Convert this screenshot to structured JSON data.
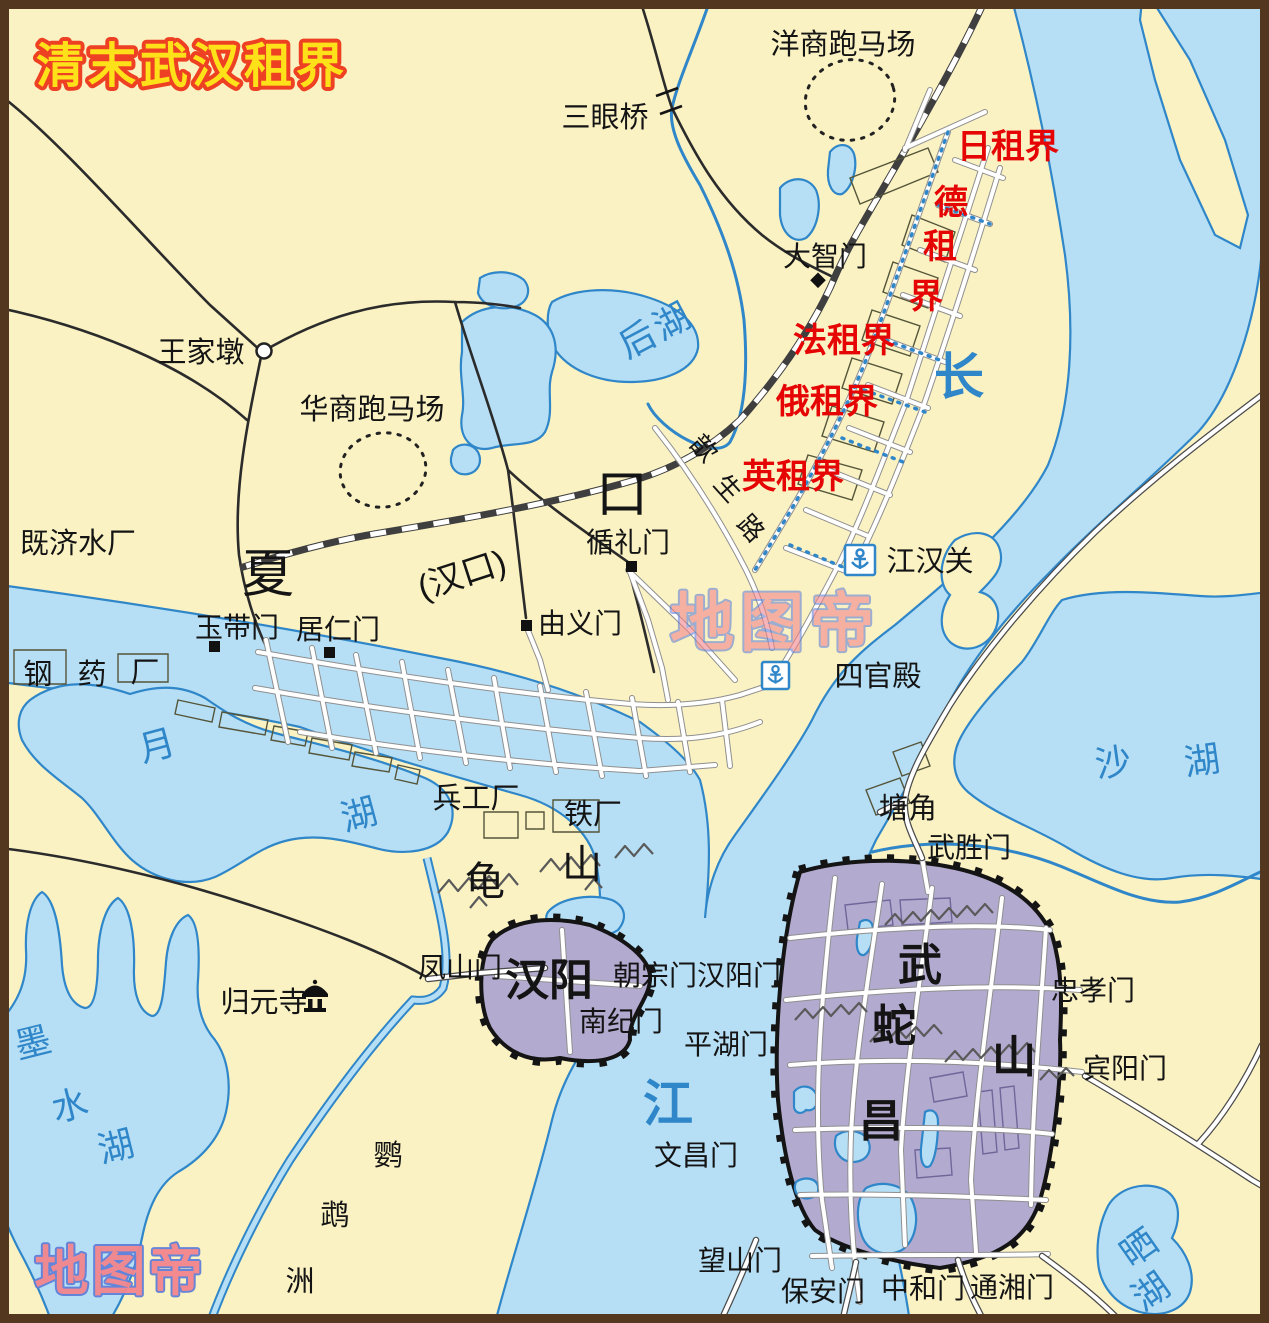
{
  "title": "清末武汉租界",
  "watermark": {
    "center": "地图帝",
    "corner": "地图帝"
  },
  "concessions": {
    "japan": "日租界",
    "germany": [
      "德",
      "租",
      "界"
    ],
    "france": "法租界",
    "russia": "俄租界",
    "britain": "英租界"
  },
  "hankou": {
    "big_chars": [
      "夏",
      "口"
    ],
    "paren_name": "(汉口)",
    "xinsheng_road": [
      "歆",
      "生",
      "路"
    ],
    "gates": {
      "dazhi": "大智门",
      "xunli": "循礼门",
      "yudai": "玉带门",
      "juren": "居仁门",
      "youyi": "由义门"
    },
    "waterworks": "既济水厂",
    "factories": [
      "钢",
      "药",
      "厂"
    ],
    "racecourse_foreign": "洋商跑马场",
    "racecourse_chinese": "华商跑马场",
    "sanyan_bridge": "三眼桥",
    "wangjiadun": "王家墩",
    "customs": "江汉关",
    "siguandian": "四官殿"
  },
  "hanyang": {
    "name": "汉阳",
    "turtle_hill": [
      "龟",
      "山"
    ],
    "arsenal": "兵工厂",
    "ironworks": "铁厂",
    "guiyuan_temple": "归元寺",
    "gates": {
      "fengshan": "凤山门",
      "chaozong_hanyang": "朝宗门汉阳门",
      "nanji": "南纪门"
    }
  },
  "wuchang": {
    "big_chars": [
      "武",
      "昌"
    ],
    "snake_hill": [
      "蛇",
      "山"
    ],
    "tangjiao": "塘角",
    "gates": {
      "wusheng": "武胜门",
      "zhongxiao": "忠孝门",
      "binyang": "宾阳门",
      "pinghu": "平湖门",
      "wenchang": "文昌门",
      "wangshan": "望山门",
      "baoan": "保安门",
      "zhonghe": "中和门",
      "tongxiang": "通湘门"
    }
  },
  "waters": {
    "yangtze": [
      "长",
      "江"
    ],
    "houhu": "后湖",
    "yuehu": [
      "月",
      "湖"
    ],
    "moshuihu": [
      "墨",
      "水",
      "湖"
    ],
    "shahu": [
      "沙",
      "湖"
    ],
    "shaihu": [
      "晒",
      "湖"
    ],
    "parrot_island": [
      "鹦",
      "鹉",
      "洲"
    ]
  },
  "colors": {
    "land": "#faf2c3",
    "water": "#b6dff5",
    "water_line": "#2f86c8",
    "city_fill": "#b3aacf",
    "concession_label": "#e60505",
    "title_fill": "#ffe11a",
    "title_stroke": "#ee4023",
    "watermark_fill": "#f2858d",
    "watermark_stroke": "#6080d8"
  }
}
